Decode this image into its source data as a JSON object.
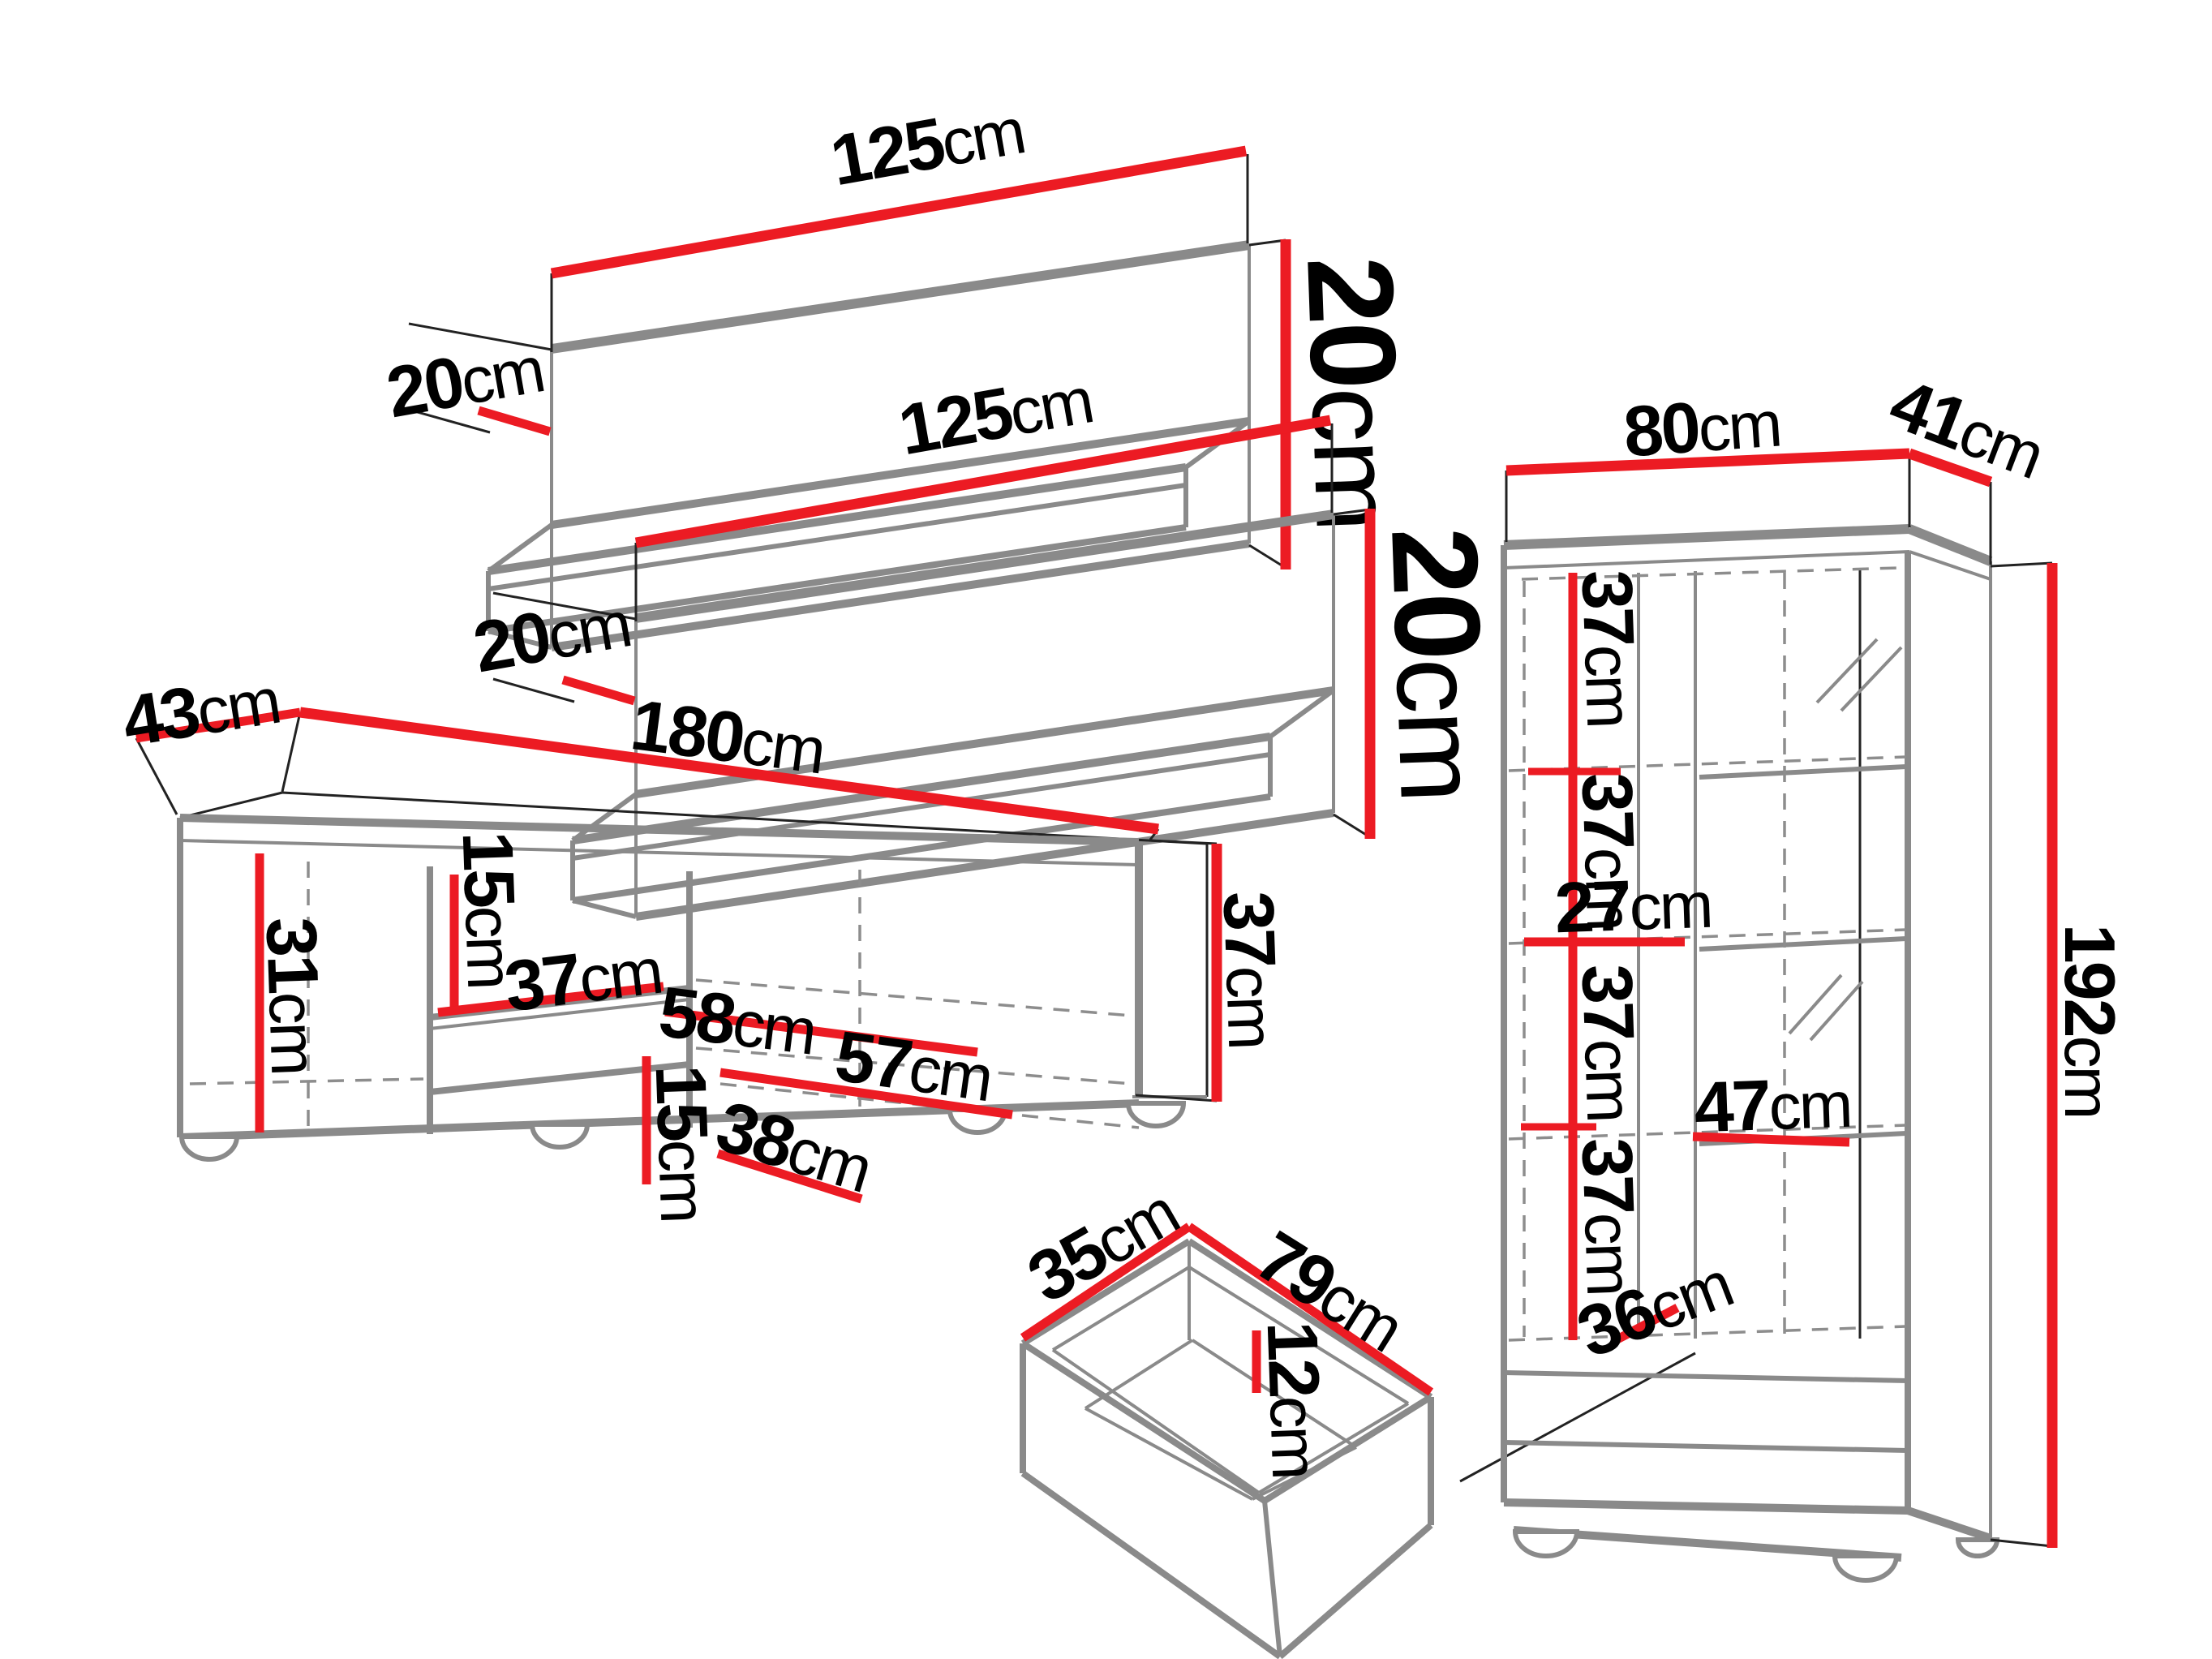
{
  "diagram": {
    "type": "furniture-dimension-diagram",
    "unit": "cm",
    "colors": {
      "dimension_line": "#ec1b23",
      "outline": "#8a8a8a",
      "text": "#000000",
      "background": "#ffffff"
    },
    "pieces": [
      {
        "id": "wall-shelf-top",
        "kind": "wall shelf",
        "dims": [
          {
            "name": "width",
            "v": "125",
            "u": "cm"
          },
          {
            "name": "depth",
            "v": "20",
            "u": "cm"
          },
          {
            "name": "height",
            "v": "20",
            "u": "cm"
          }
        ]
      },
      {
        "id": "wall-shelf-middle",
        "kind": "wall shelf",
        "dims": [
          {
            "name": "width",
            "v": "125",
            "u": "cm"
          },
          {
            "name": "depth",
            "v": "20",
            "u": "cm"
          },
          {
            "name": "height",
            "v": "20",
            "u": "cm"
          }
        ]
      },
      {
        "id": "tv-stand",
        "kind": "tv stand",
        "dims": [
          {
            "name": "depth",
            "v": "43",
            "u": "cm"
          },
          {
            "name": "width",
            "v": "180",
            "u": "cm"
          },
          {
            "name": "height",
            "v": "37",
            "u": "cm"
          },
          {
            "name": "inner-left-height",
            "v": "31",
            "u": "cm"
          },
          {
            "name": "upper-niche-height",
            "v": "15",
            "u": "cm"
          },
          {
            "name": "niche-depth",
            "v": "37",
            "u": "cm"
          },
          {
            "name": "niche-width",
            "v": "58",
            "u": "cm"
          },
          {
            "name": "right-inner-width",
            "v": "57",
            "u": "cm"
          },
          {
            "name": "lower-niche-height",
            "v": "15",
            "u": "cm"
          },
          {
            "name": "lower-niche-width",
            "v": "38",
            "u": "cm"
          }
        ]
      },
      {
        "id": "drawer",
        "kind": "drawer box",
        "dims": [
          {
            "name": "depth",
            "v": "35",
            "u": "cm"
          },
          {
            "name": "width",
            "v": "79",
            "u": "cm"
          },
          {
            "name": "height",
            "v": "12",
            "u": "cm"
          }
        ]
      },
      {
        "id": "display-cabinet",
        "kind": "tall display cabinet",
        "dims": [
          {
            "name": "width",
            "v": "80",
            "u": "cm"
          },
          {
            "name": "depth",
            "v": "41",
            "u": "cm"
          },
          {
            "name": "height",
            "v": "192",
            "u": "cm"
          },
          {
            "name": "shelf-gap-1",
            "v": "37",
            "u": "cm"
          },
          {
            "name": "shelf-gap-2",
            "v": "37",
            "u": "cm"
          },
          {
            "name": "left-col-width",
            "v": "27",
            "u": "cm"
          },
          {
            "name": "shelf-gap-3",
            "v": "37",
            "u": "cm"
          },
          {
            "name": "right-col-width",
            "v": "47",
            "u": "cm"
          },
          {
            "name": "shelf-gap-4",
            "v": "37",
            "u": "cm"
          },
          {
            "name": "bottom-width",
            "v": "36",
            "u": "cm"
          }
        ]
      }
    ]
  }
}
